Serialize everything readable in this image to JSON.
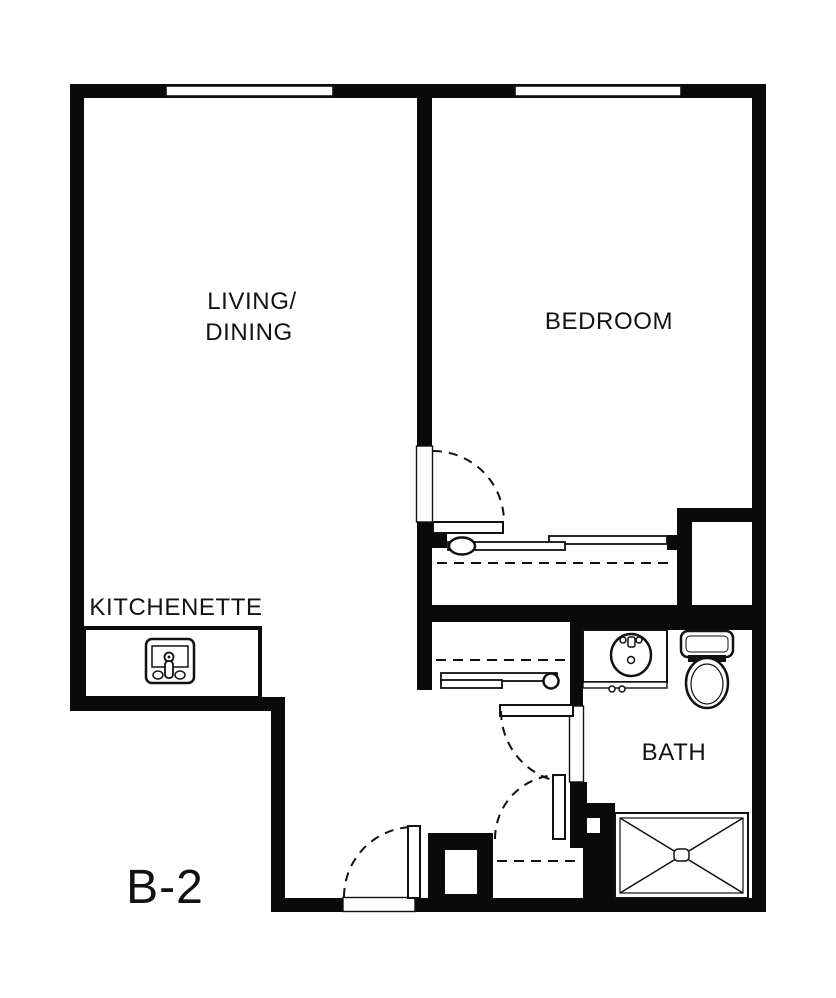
{
  "plan": {
    "unit_label": "B-2",
    "rooms": {
      "living_dining": {
        "label_line1": "LIVING/",
        "label_line2": "DINING"
      },
      "bedroom": {
        "label": "BEDROOM"
      },
      "kitchenette": {
        "label": "KITCHENETTE"
      },
      "bath": {
        "label": "BATH"
      }
    },
    "colors": {
      "wall": "#0a0a0a",
      "line": "#111111",
      "background": "#ffffff"
    },
    "windows": {
      "count": 2,
      "locations": [
        "top-wall-living",
        "top-wall-bedroom"
      ]
    },
    "doors": [
      {
        "name": "bedroom-door",
        "type": "swing"
      },
      {
        "name": "bath-door",
        "type": "swing"
      },
      {
        "name": "hall-closet-door",
        "type": "swing"
      },
      {
        "name": "entry-door",
        "type": "swing"
      },
      {
        "name": "bedroom-closet-doors",
        "type": "sliding"
      },
      {
        "name": "hall-closet-sliding-door",
        "type": "sliding"
      }
    ],
    "fixtures": [
      "kitchen-sink-icon",
      "bath-sink-icon",
      "toilet-icon",
      "shower-icon"
    ]
  }
}
